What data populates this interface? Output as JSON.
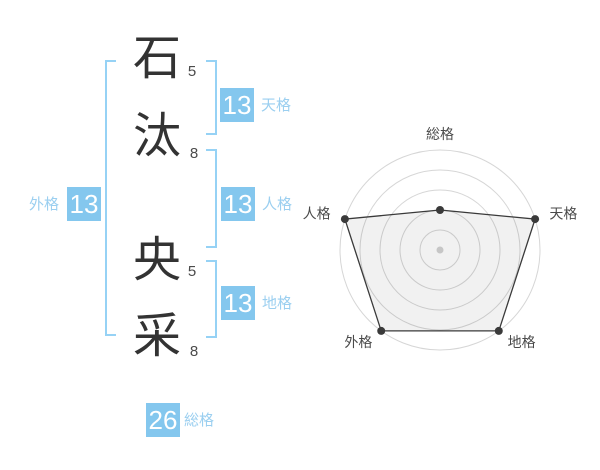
{
  "name": {
    "characters": [
      {
        "char": "石",
        "strokes": "5"
      },
      {
        "char": "汰",
        "strokes": "8"
      },
      {
        "char": "央",
        "strokes": "5"
      },
      {
        "char": "采",
        "strokes": "8"
      }
    ]
  },
  "kaku_badges": {
    "tenkaku": {
      "label": "天格",
      "value": "13"
    },
    "jinkaku": {
      "label": "人格",
      "value": "13"
    },
    "chikaku": {
      "label": "地格",
      "value": "13"
    },
    "gaikaku": {
      "label": "外格",
      "value": "13"
    },
    "soukaku": {
      "label": "総格",
      "value": "26"
    }
  },
  "colors": {
    "badge_blue": "#84c7ee",
    "label_blue": "#9bcff0",
    "bracket_blue": "#96d2f5",
    "kanji_text": "#333333",
    "radar_polygon": "#3a3a3a",
    "radar_ring": "#d6d6d6",
    "radar_center_dot": "#c6c6c6"
  },
  "chart_data": {
    "type": "radar",
    "axes": [
      "総格",
      "天格",
      "地格",
      "外格",
      "人格"
    ],
    "values": [
      26,
      13,
      13,
      13,
      13
    ],
    "plotted_radius_pct": [
      40,
      100,
      100,
      100,
      100
    ],
    "rings": 5,
    "grid": "circular",
    "legend": "none",
    "start_axis": "top",
    "direction": "clockwise"
  }
}
